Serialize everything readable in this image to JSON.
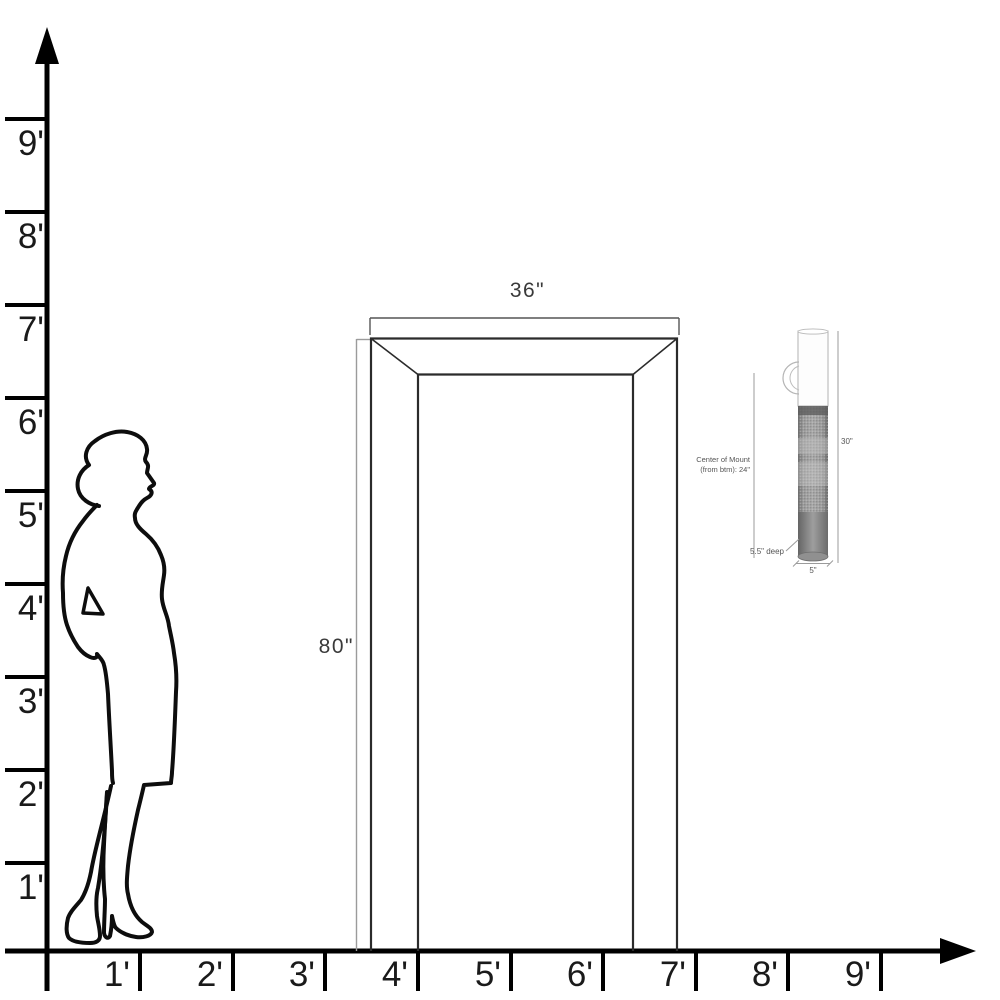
{
  "diagram": {
    "description": "Scale diagram: woman silhouette, 36in x 80in door frame, and cylindrical wall sconce with mounting dimensions",
    "background": "#ffffff"
  },
  "rulers": {
    "vertical": {
      "unit": "feet",
      "labels": [
        "9'",
        "8'",
        "7'",
        "6'",
        "5'",
        "4'",
        "3'",
        "2'",
        "1'"
      ]
    },
    "horizontal": {
      "unit": "feet",
      "labels": [
        "1'",
        "2'",
        "3'",
        "4'",
        "5'",
        "6'",
        "7'",
        "8'",
        "9'"
      ]
    }
  },
  "door": {
    "width_label": "36\"",
    "height_label": "80\""
  },
  "sconce": {
    "height_label": "30\"",
    "width_label": "5\"",
    "depth_label": "5.5\" deep",
    "mount_line1": "Center of Mount",
    "mount_line2": "(from btm): 24\""
  },
  "colors": {
    "axis": "#000000",
    "door_line": "#2b2b2b",
    "dimension_line": "#9b9b9b",
    "dimension_text": "#3a3a3a",
    "sconce_text": "#555555",
    "sconce_body": "#9a9a9a"
  }
}
